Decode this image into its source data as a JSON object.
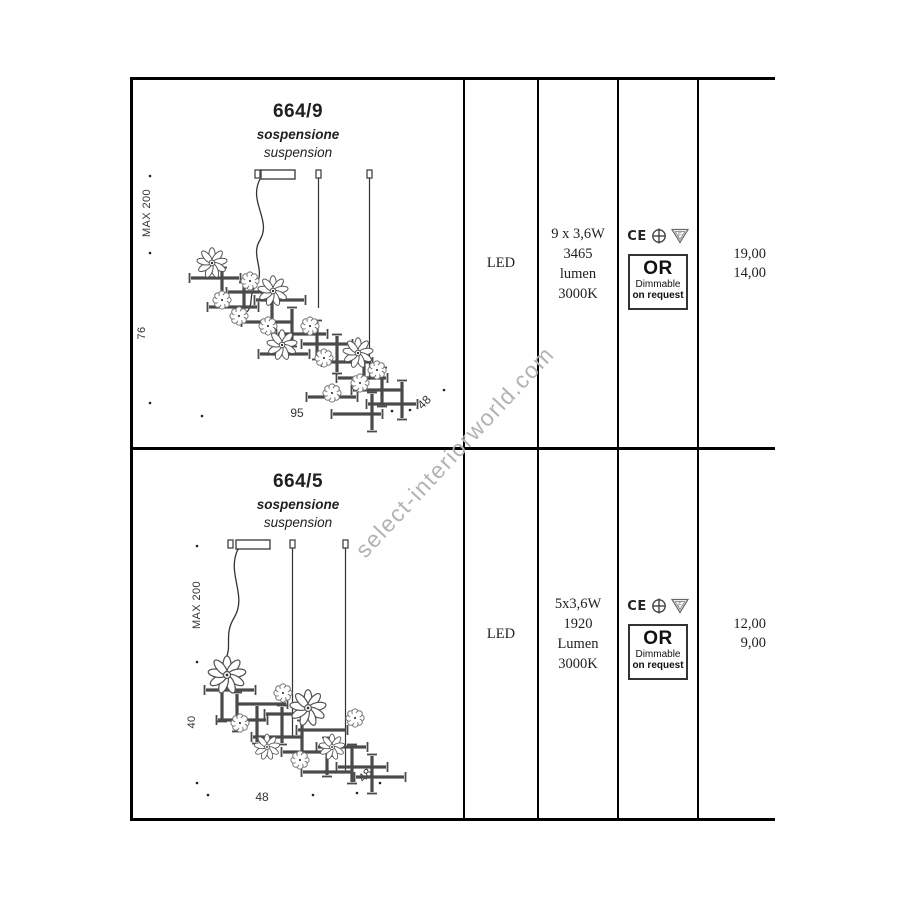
{
  "watermark": "select-interiorworld.com",
  "colors": {
    "border": "#000000",
    "watermark": "#b3b3b3",
    "text": "#1f1f1f"
  },
  "rows": [
    {
      "model": "664/9",
      "type_it": "sospensione",
      "type_en": "suspension",
      "lamp": "LED",
      "specs": [
        "9 x 3,6W",
        "3465",
        "lumen",
        "3000K"
      ],
      "cert": {
        "ce": "CE",
        "icon2": "earth-cross-circle-icon",
        "icon3": "f-triangle-icon"
      },
      "or_box": {
        "title": "OR",
        "line1": "Dimmable",
        "line2": "on request"
      },
      "prices": [
        "19,00",
        "14,00"
      ],
      "dims": {
        "max": "MAX 200",
        "side": "76",
        "width": "95",
        "depth": "48"
      }
    },
    {
      "model": "664/5",
      "type_it": "sospensione",
      "type_en": "suspension",
      "lamp": "LED",
      "specs": [
        "5x3,6W",
        "1920",
        "Lumen",
        "3000K"
      ],
      "cert": {
        "ce": "CE",
        "icon2": "earth-cross-circle-icon",
        "icon3": "f-triangle-icon"
      },
      "or_box": {
        "title": "OR",
        "line1": "Dimmable",
        "line2": "on request"
      },
      "prices": [
        "12,00",
        "9,00"
      ],
      "dims": {
        "max": "MAX 200",
        "side": "40",
        "width": "48",
        "depth": "48"
      }
    }
  ]
}
